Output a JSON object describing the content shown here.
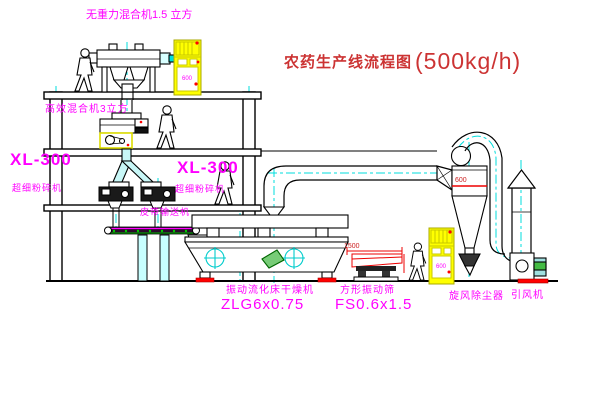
{
  "title": {
    "name": "农药生产线流程图",
    "capacity": "(500kg/h)"
  },
  "labels": {
    "top_mixer": "无重力混合机1.5 立方",
    "mixer_3m3": "高效混合机3立方",
    "mill_left_model": "XL-300",
    "mill_left_name": "超细粉碎机",
    "mill_mid_model": "XL-300",
    "mill_mid_name": "超细粉碎机",
    "belt_conveyor": "皮带输送机",
    "dryer_name": "振动流化床干燥机",
    "dryer_model": "ZLG6x0.75",
    "sieve_name": "方形振动筛",
    "sieve_model": "FS0.6x1.5",
    "cyclone_name": "旋风除尘器",
    "fan_name": "引风机"
  },
  "dimensions": {
    "sieve_width": "1500",
    "cyclone_diameter": "600"
  },
  "cabinets": {
    "cabinet1_text": "600",
    "cabinet2_text": "600"
  },
  "colors": {
    "label_magenta": "#ff00ff",
    "title_red": "#cc3333",
    "dimension_red": "#ee0000",
    "equipment_yellow": "#ffff00",
    "centerline_cyan": "#00dddd",
    "detail_green": "#00aa00"
  }
}
